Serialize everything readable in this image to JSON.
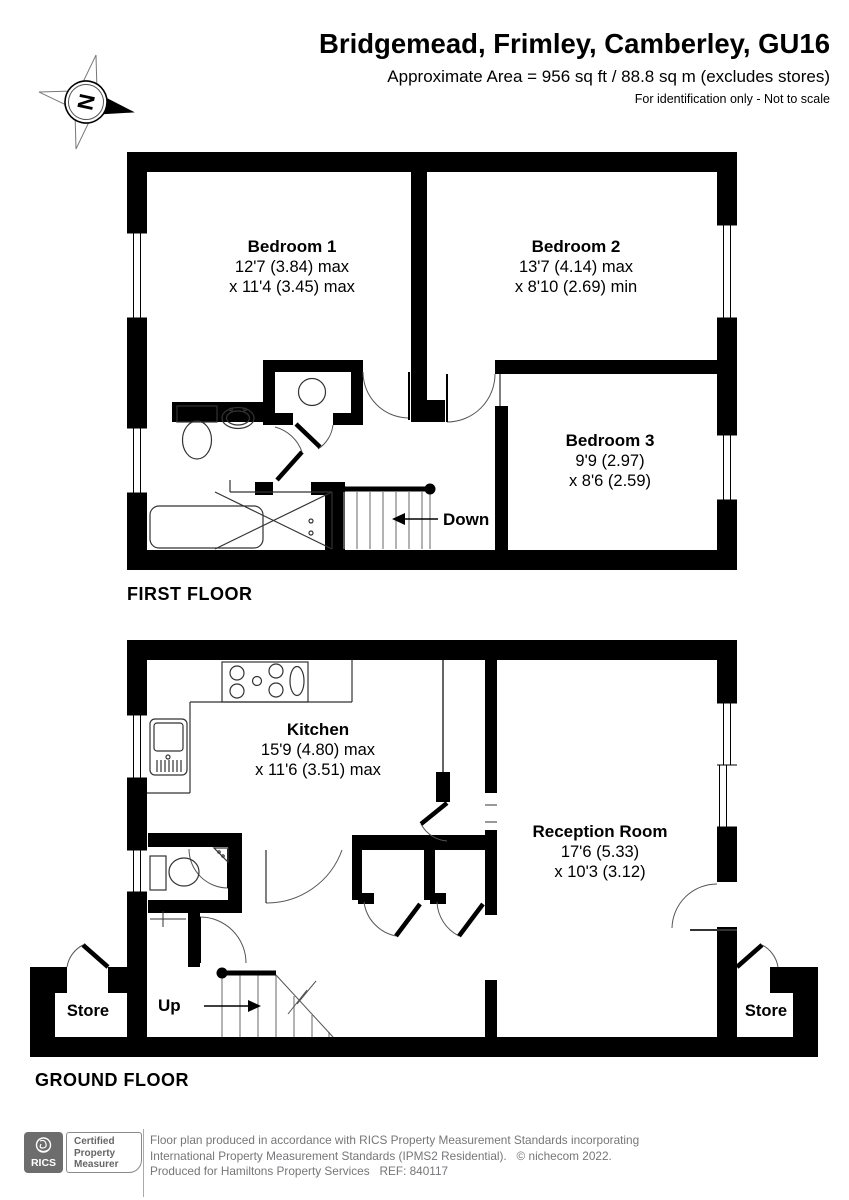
{
  "header": {
    "title": "Bridgemead, Frimley, Camberley, GU16",
    "subtitle": "Approximate Area = 956 sq ft / 88.8 sq m (excludes stores)",
    "note": "For identification only - Not to scale"
  },
  "compass": {
    "label": "N"
  },
  "first_floor": {
    "label": "FIRST FLOOR",
    "stairs_label": "Down",
    "rooms": [
      {
        "name": "Bedroom 1",
        "dim1": "12'7 (3.84) max",
        "dim2": "x 11'4 (3.45) max"
      },
      {
        "name": "Bedroom 2",
        "dim1": "13'7 (4.14) max",
        "dim2": "x 8'10 (2.69) min"
      },
      {
        "name": "Bedroom 3",
        "dim1": "9'9 (2.97)",
        "dim2": "x 8'6 (2.59)"
      }
    ]
  },
  "ground_floor": {
    "label": "GROUND FLOOR",
    "stairs_label": "Up",
    "store_left_label": "Store",
    "store_right_label": "Store",
    "rooms": [
      {
        "name": "Kitchen",
        "dim1": "15'9 (4.80) max",
        "dim2": "x 11'6 (3.51) max"
      },
      {
        "name": "Reception Room",
        "dim1": "17'6 (5.33)",
        "dim2": "x 10'3 (3.12)"
      }
    ]
  },
  "footer": {
    "rics_logo_text": "RICS",
    "badge_lines": [
      "Certified",
      "Property",
      "Measurer"
    ],
    "line1": "Floor plan produced in accordance with RICS Property Measurement Standards incorporating",
    "line2": "International Property Measurement Standards (IPMS2 Residential).   © nichecom 2022.",
    "line3": "Produced for Hamiltons Property Services   REF: 840117"
  },
  "colors": {
    "wall": "#000000",
    "door_arc": "#555555",
    "stair_tread": "#8a8a8a",
    "footer_text": "#76767a",
    "rics_box": "#6d6d6d",
    "badge_border": "#8a8a8a"
  }
}
